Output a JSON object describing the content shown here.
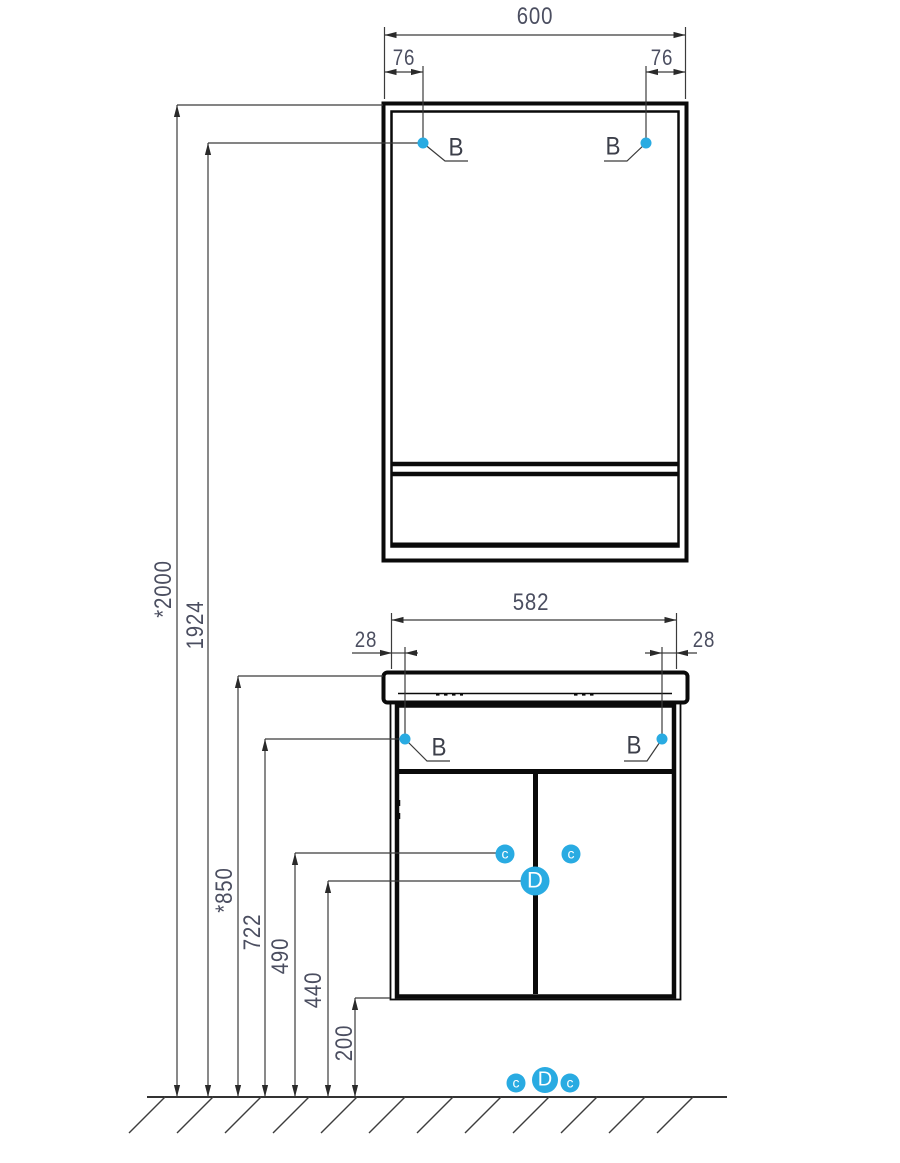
{
  "drawing": {
    "type": "furniture installation dimension drawing",
    "units_shown": "mm",
    "mirror_cabinet": {
      "width_label": "600",
      "bracket_offset_left": "76",
      "bracket_offset_right": "76",
      "bracket_callout_left": "B",
      "bracket_callout_right": "B"
    },
    "vanity_cabinet": {
      "width_label": "582",
      "bracket_offset_left": "28",
      "bracket_offset_right": "28",
      "bracket_callout_left": "B",
      "bracket_callout_right": "B",
      "door_callout_left": "c",
      "door_callout_right": "c",
      "door_callout_center": "D"
    },
    "floor_callouts": {
      "left": "c",
      "center": "D",
      "right": "c"
    },
    "heights": {
      "total": "*2000",
      "mirror_bracket": "1924",
      "countertop": "*850",
      "cabinet_bracket": "722",
      "callout_c_height": "490",
      "callout_d_height": "440",
      "cabinet_bottom": "200"
    },
    "colors": {
      "accent": "#29abe2",
      "furniture_line": "#0a0a0a",
      "dimension_line": "#3b3b3b",
      "dimension_text": "#4b4e60"
    }
  }
}
